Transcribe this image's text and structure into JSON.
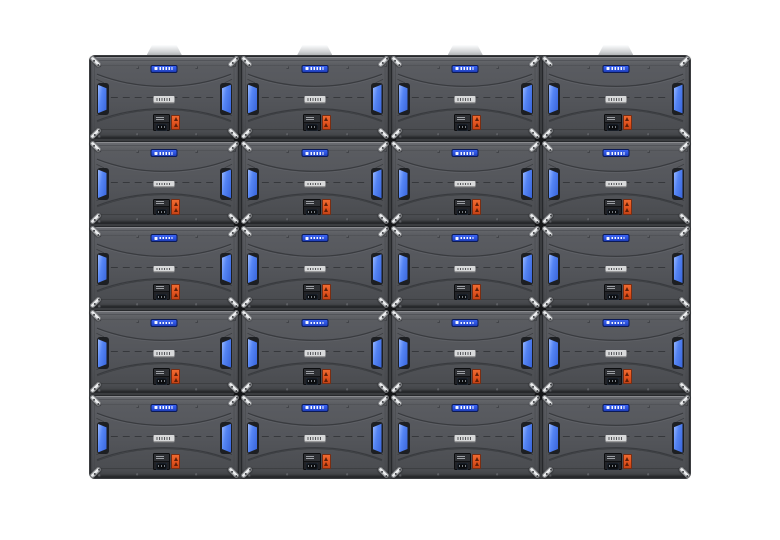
{
  "scene": {
    "type": "product-render",
    "subject": "Rear view of a modular LED display video wall made of identical cabinets",
    "background_color": "#ffffff"
  },
  "wall": {
    "columns": 4,
    "rows": 5,
    "panel_count": 20
  },
  "panel": {
    "body_color": "#54565b",
    "border_color": "#26282b",
    "gap_color": "#3b3d40",
    "vent_color": "#5585f4",
    "badge_color": "#2b51dd",
    "label_color": "#d8d9da",
    "module_color": "#212226",
    "connector_color": "#e2531f",
    "bracket_color": "#d7d9db",
    "bracket_dot_color": "#3f4145",
    "handle_color": "#cfd1d3",
    "screw_color": "#2f3135",
    "features": {
      "brand_badge": "small blue badge with white logo marks, top center",
      "serial_label": "small white barcode label, panel center",
      "vents": "curved blue ventilation inserts on left and right edges",
      "status_module": "black receiving-card module with tiny status display, bottom center",
      "power_connector": "orange power connector with 2 warning-triangle marks",
      "corner_brackets": "bright metal lock brackets arranged in an X at each panel junction",
      "lift_handles": "light gray trapezoid handle plates protruding from the top edge of the top row",
      "warning_icon_count_per_connector": 2
    }
  }
}
